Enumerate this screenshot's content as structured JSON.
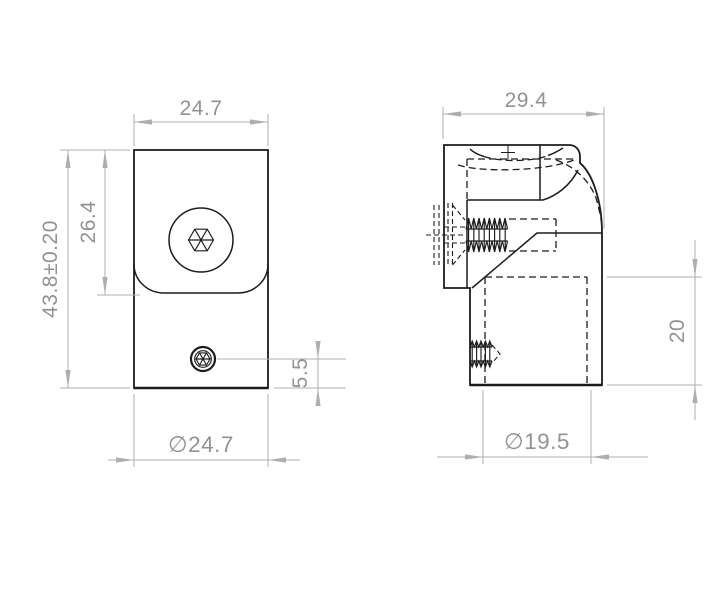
{
  "drawing": {
    "front_view": {
      "top_width": "24.7",
      "overall_height": "43.8±0.20",
      "saddle_height": "26.4",
      "set_screw_offset": "5.5",
      "base_diameter": "∅24.7"
    },
    "side_view": {
      "top_width": "29.4",
      "base_diameter": "∅19.5",
      "socket_depth": "20"
    },
    "colors": {
      "part_line": "#1c1c1c",
      "hidden_line": "#1c1c1c",
      "dimension_line": "#abafb2",
      "dimension_text": "#8f9396",
      "background": "#ffffff"
    }
  }
}
